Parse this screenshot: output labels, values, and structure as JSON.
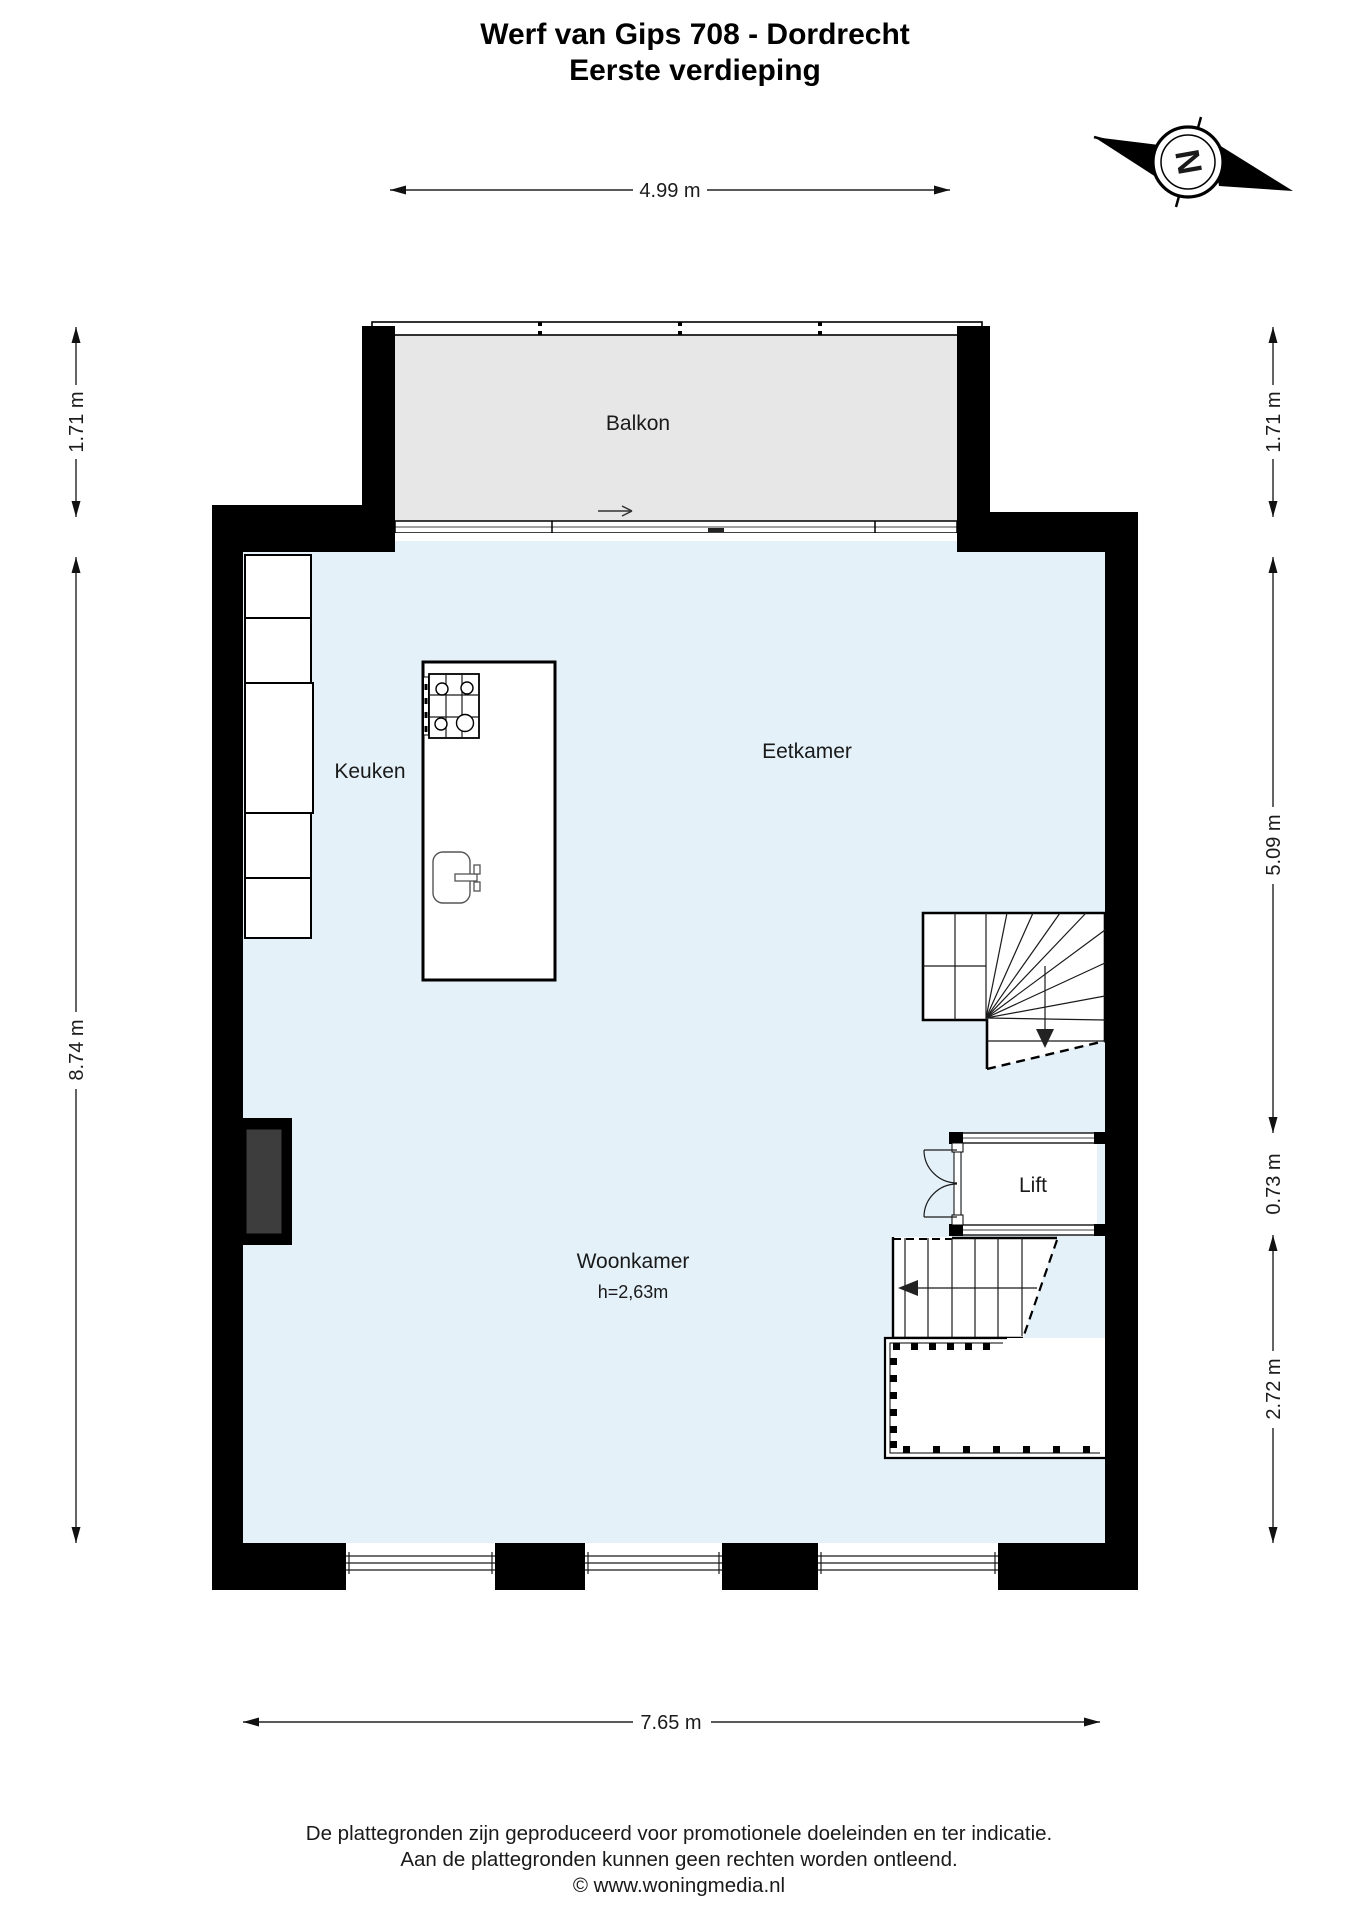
{
  "title": {
    "line1": "Werf van Gips 708 - Dordrecht",
    "line2": "Eerste verdieping"
  },
  "compass": {
    "letter": "N"
  },
  "rooms": {
    "balkon": "Balkon",
    "keuken": "Keuken",
    "eetkamer": "Eetkamer",
    "woonkamer": "Woonkamer",
    "woonkamer_ceiling": "h=2,63m",
    "lift": "Lift"
  },
  "dimensions": {
    "top_width": "4.99 m",
    "bottom_width": "7.65 m",
    "left_balcony": "1.71 m",
    "left_main": "8.74 m",
    "right_balcony": "1.71 m",
    "right_upper": "5.09 m",
    "right_lift": "0.73 m",
    "right_lower": "2.72 m"
  },
  "footer": {
    "line1": "De plattegronden zijn geproduceerd voor promotionele doeleinden en ter indicatie.",
    "line2": "Aan de plattegronden kunnen geen rechten worden ontleend.",
    "line3": "© www.woningmedia.nl"
  },
  "colors": {
    "wall": "#000000",
    "floor": "#e4f1f9",
    "balcony": "#e7e7e7",
    "dark_block": "#3d3d3d",
    "line": "#1a1a1a"
  }
}
